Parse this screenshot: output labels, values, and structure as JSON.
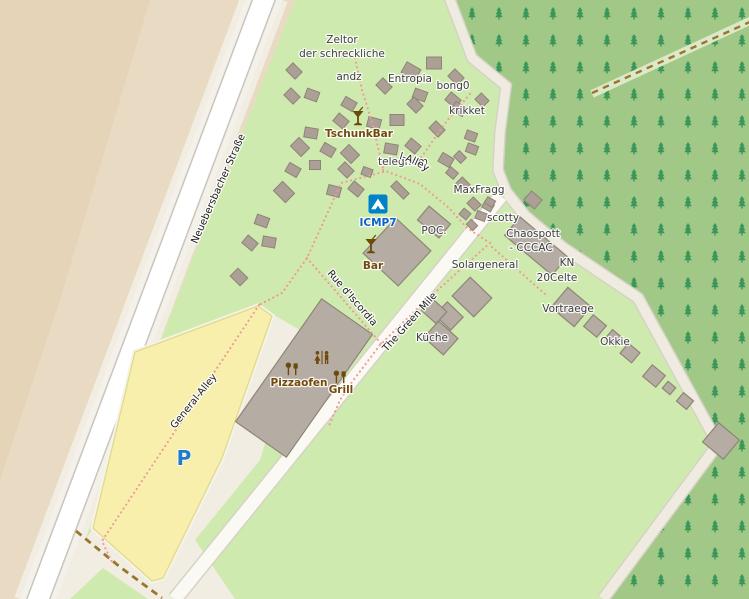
{
  "map": {
    "colors": {
      "farmland": "#e9dbc3",
      "farmland_dark": "#e5d4b8",
      "camp_green": "#cfeaae",
      "forest_green": "#a2c887",
      "tree": "#3b9659",
      "road_white": "#ffffff",
      "sidewalk": "#f4f1ea",
      "road_casing": "#c9c5bb",
      "apron": "#f1ede2",
      "path_pale": "#f0ebe1",
      "path_casing": "#d6d2c6",
      "parking_yellow": "#f9efad",
      "parking_border": "#e0da8e",
      "building": "#b5aca4",
      "building_stroke": "#8f8478",
      "tent": "#aca096",
      "tent_stroke": "#8f8478",
      "dotted_path": "#ee9a95",
      "track_brown": "#9a762d",
      "track_band": "#dbe9c9",
      "amenity_brown": "#734a08",
      "tourism_blue": "#0d62c9",
      "parking_blue": "#1f7bd0",
      "camp_icon_bg": "#0082c8"
    },
    "labels": [
      {
        "text": "Zeltor",
        "x": 342,
        "y": 43,
        "cls": "place"
      },
      {
        "text": "der schreckliche",
        "x": 342,
        "y": 57,
        "cls": "place"
      },
      {
        "text": "andz",
        "x": 349,
        "y": 80,
        "cls": "place"
      },
      {
        "text": "Entropia",
        "x": 410,
        "y": 82,
        "cls": "place"
      },
      {
        "text": "bong0",
        "x": 453,
        "y": 89,
        "cls": "place"
      },
      {
        "text": "krikket",
        "x": 467,
        "y": 114,
        "cls": "place"
      },
      {
        "text": "TschunkBar",
        "x": 359,
        "y": 137,
        "cls": "amenity"
      },
      {
        "text": "telegnom",
        "x": 403,
        "y": 165,
        "cls": "place"
      },
      {
        "text": "General-Alley",
        "cls": "road",
        "pathRef": "#ga-curve"
      },
      {
        "text": "MaxFragg",
        "x": 479,
        "y": 193,
        "cls": "place"
      },
      {
        "text": "ICMP7",
        "x": 378,
        "y": 226,
        "cls": "tourism"
      },
      {
        "text": "POC.",
        "x": 434,
        "y": 234,
        "cls": "place"
      },
      {
        "text": "scotty",
        "x": 503,
        "y": 221,
        "cls": "place"
      },
      {
        "text": "Chaospott",
        "x": 533,
        "y": 237,
        "cls": "place"
      },
      {
        "text": "- CCCAC",
        "x": 531,
        "y": 251,
        "cls": "place"
      },
      {
        "text": "Bar",
        "x": 373,
        "y": 269,
        "cls": "amenity"
      },
      {
        "text": "Solargeneral",
        "x": 485,
        "y": 268,
        "cls": "place"
      },
      {
        "text": "KN",
        "x": 567,
        "y": 266,
        "cls": "place"
      },
      {
        "text": "20Celte",
        "x": 557,
        "y": 281,
        "cls": "place"
      },
      {
        "text": "Rue d'Iscordia",
        "x": 350,
        "y": 300,
        "rot": 49,
        "cls": "road"
      },
      {
        "text": "The Green Mile",
        "x": 412,
        "y": 324,
        "rot": -48,
        "cls": "road"
      },
      {
        "text": "Vortraege",
        "x": 568,
        "y": 312,
        "cls": "place"
      },
      {
        "text": "Küche",
        "x": 432,
        "y": 341,
        "cls": "place"
      },
      {
        "text": "Okkie",
        "x": 615,
        "y": 345,
        "cls": "place"
      },
      {
        "text": "Pizzaofen",
        "x": 299,
        "y": 386,
        "cls": "amenity"
      },
      {
        "text": "Grill",
        "x": 341,
        "y": 393,
        "cls": "amenity"
      },
      {
        "text": "General-Alley",
        "x": 196,
        "y": 403,
        "rot": -51,
        "cls": "road"
      },
      {
        "text": "Neuebersbacher Straße",
        "x": 221,
        "y": 190,
        "rot": -66,
        "cls": "road"
      },
      {
        "text": "P",
        "x": 184,
        "y": 465,
        "cls": "parking"
      }
    ],
    "icons": [
      {
        "name": "cocktail-icon",
        "x": 358,
        "y": 119
      },
      {
        "name": "cocktail-icon",
        "x": 371,
        "y": 247
      },
      {
        "name": "campsite-icon",
        "x": 378,
        "y": 204
      },
      {
        "name": "toilets-icon",
        "x": 322,
        "y": 358
      },
      {
        "name": "oven-icon",
        "x": 292,
        "y": 369
      },
      {
        "name": "bbq-icon",
        "x": 340,
        "y": 377
      }
    ],
    "tents": [
      [
        294,
        71,
        45
      ],
      [
        292,
        96,
        45
      ],
      [
        312,
        95,
        20
      ],
      [
        349,
        104,
        30
      ],
      [
        384,
        86,
        45
      ],
      [
        411,
        71,
        30,
        16,
        12
      ],
      [
        434,
        63,
        0,
        15,
        12
      ],
      [
        456,
        77,
        45
      ],
      [
        420,
        95,
        20
      ],
      [
        453,
        100,
        40
      ],
      [
        482,
        100,
        45,
        11,
        9
      ],
      [
        341,
        121,
        40
      ],
      [
        311,
        133,
        10
      ],
      [
        374,
        123,
        15
      ],
      [
        415,
        105,
        45
      ],
      [
        459,
        109,
        30
      ],
      [
        397,
        120,
        0,
        14,
        11
      ],
      [
        437,
        129,
        45
      ],
      [
        471,
        136,
        20,
        11,
        9
      ],
      [
        413,
        146,
        40
      ],
      [
        391,
        149,
        10
      ],
      [
        350,
        154,
        45,
        15,
        12
      ],
      [
        328,
        150,
        30
      ],
      [
        315,
        165,
        0,
        11,
        9
      ],
      [
        346,
        170,
        45
      ],
      [
        367,
        172,
        20,
        10,
        8
      ],
      [
        356,
        189,
        40
      ],
      [
        334,
        191,
        15
      ],
      [
        400,
        190,
        45,
        18,
        8
      ],
      [
        300,
        147,
        45,
        15,
        12
      ],
      [
        293,
        170,
        30
      ],
      [
        284,
        192,
        45,
        17,
        13
      ],
      [
        262,
        221,
        20
      ],
      [
        250,
        243,
        40
      ],
      [
        269,
        242,
        10
      ],
      [
        239,
        277,
        45,
        14,
        11
      ],
      [
        446,
        160,
        30
      ],
      [
        460,
        157,
        45,
        10,
        8
      ],
      [
        472,
        149,
        20,
        11,
        9
      ],
      [
        452,
        173,
        40,
        10,
        8
      ],
      [
        463,
        184,
        45,
        11,
        9
      ],
      [
        488,
        206,
        30,
        10,
        8
      ],
      [
        474,
        204,
        45,
        11,
        9
      ],
      [
        481,
        216,
        20,
        10,
        8
      ],
      [
        465,
        214,
        40,
        9,
        8
      ],
      [
        472,
        225,
        45,
        9,
        7
      ],
      [
        533,
        200,
        40,
        14,
        12
      ],
      [
        490,
        202,
        30,
        9,
        7
      ]
    ],
    "buildings": [
      [
        397,
        252,
        48,
        48,
        43
      ],
      [
        434,
        222,
        28,
        18,
        40
      ],
      [
        536,
        246,
        62,
        24,
        40
      ],
      [
        472,
        297,
        30,
        26,
        44
      ],
      [
        449,
        316,
        22,
        18,
        44
      ],
      [
        434,
        311,
        20,
        16,
        42
      ],
      [
        441,
        338,
        26,
        22,
        42
      ],
      [
        571,
        307,
        30,
        26,
        40
      ],
      [
        595,
        326,
        17,
        15,
        40
      ],
      [
        614,
        338,
        13,
        11,
        40
      ],
      [
        630,
        353,
        15,
        13,
        40
      ],
      [
        654,
        376,
        17,
        15,
        40
      ],
      [
        669,
        388,
        10,
        9,
        40
      ],
      [
        685,
        401,
        13,
        11,
        40
      ],
      [
        721,
        441,
        27,
        25,
        40
      ],
      [
        304,
        378,
        150,
        62,
        -55
      ]
    ]
  }
}
